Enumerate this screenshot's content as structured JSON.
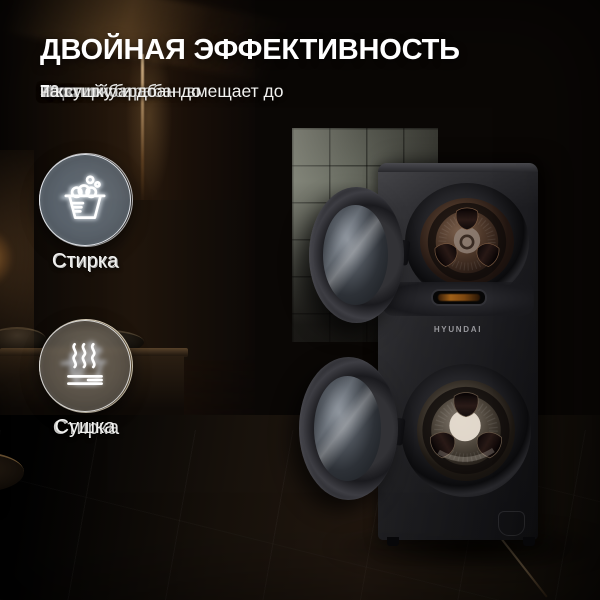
{
  "header": {
    "title": "ДВОЙНАЯ ЭФФЕКТИВНОСТЬ",
    "line1": {
      "text": "Верхний барабан вмещает до ",
      "bold": "5 кг"
    },
    "line2": {
      "p1": "Нижний барабан до ",
      "b1": "10 кг",
      "p2": " на стирку и до ",
      "b2": "7 кг",
      "p3": " на сушку"
    }
  },
  "features": {
    "plus": "+",
    "rows": [
      {
        "left": {
          "icon": "wash-icon",
          "label": "Стирка"
        },
        "right": {
          "icon": "wash-icon",
          "label": "Стирка"
        }
      },
      {
        "left": {
          "icon": "wash-icon",
          "label": "Стирка"
        },
        "right": {
          "icon": "dry-icon",
          "label": "Сушка"
        }
      }
    ]
  },
  "machine": {
    "brand": "HYUNDAI"
  },
  "colors": {
    "title_text": "#ffffff",
    "body_text": "#f2f2f0",
    "icon_stroke": "#ffffff",
    "circle_dark": "rgba(74,76,82,0.55)",
    "circle_blue": "rgba(140,160,180,0.48)",
    "circle_warm": "rgba(214,186,132,0.42)",
    "display_glow": "#b06a1a"
  }
}
